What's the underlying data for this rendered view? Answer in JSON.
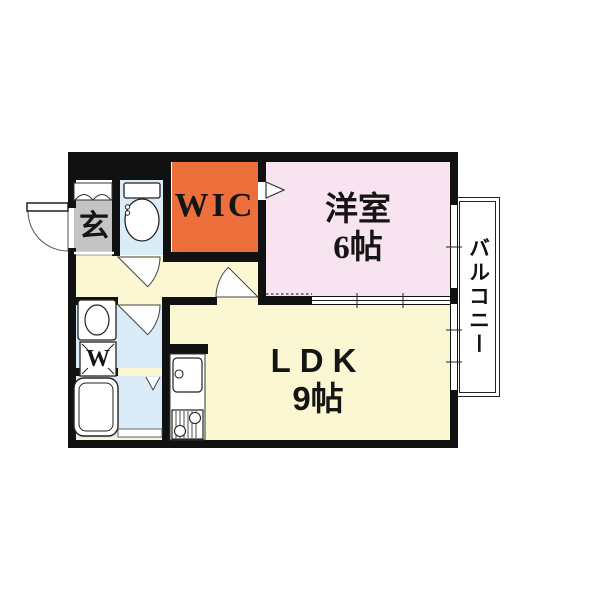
{
  "rooms": {
    "wic": {
      "label": "WIC"
    },
    "western": {
      "label": "洋室",
      "size": "6帖"
    },
    "ldk": {
      "label": "LDK",
      "size": "9帖"
    },
    "genkan": {
      "label": "玄"
    },
    "balcony": {
      "label": "バルコニー"
    },
    "laundry": {
      "label": "W"
    }
  },
  "colors": {
    "wall": "#111111",
    "wic": "#ed6f3c",
    "western_room": "#f8e3f0",
    "ldk": "#fbf7d2",
    "wet_area": "#d9ecf7",
    "genkan": "#c4c4c4",
    "background": "#ffffff"
  },
  "fixtures": {
    "entrance_door": "entrance-door-arc",
    "shoe_cabinet": "shoe-cabinet",
    "toilet": "toilet-icon",
    "washbasin": "washbasin-icon",
    "washing_machine_pan": "washing-machine-pan",
    "bathtub": "bathtub-icon",
    "kitchen_sink": "kitchen-sink-icon",
    "stove": "stove-icon",
    "sliding_window": "sliding-window",
    "balcony": "balcony"
  }
}
